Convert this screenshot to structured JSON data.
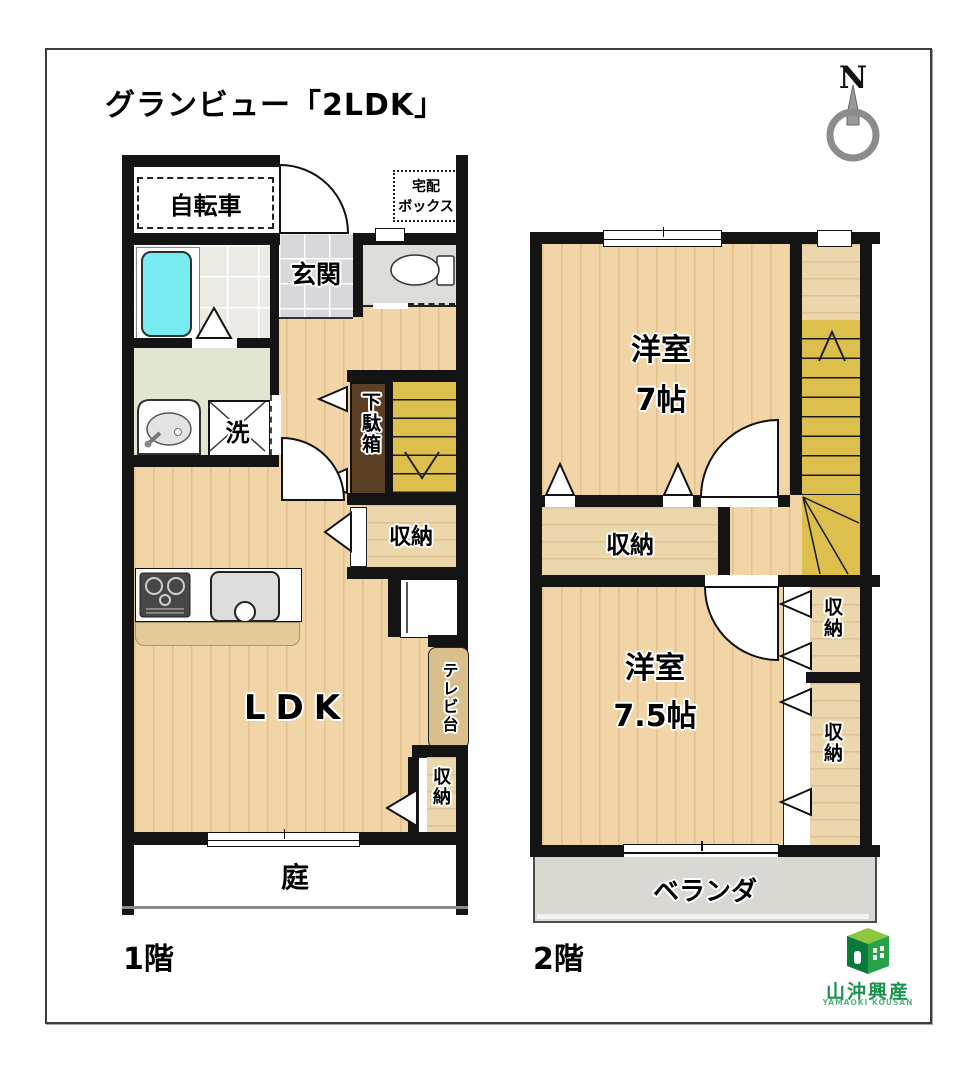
{
  "title": "グランビュー「2LDK」",
  "compass": {
    "n": "N"
  },
  "f1": {
    "caption": "1階",
    "bicycle": "自転車",
    "delivery1": "宅配",
    "delivery2": "ボックス",
    "genkan": "玄関",
    "wash": "洗",
    "shoe_cabinet": "下駄箱",
    "storage_stairs": "収納",
    "ldk": "LDK",
    "tv_stand": "テレビ台",
    "storage_ldk": "収納",
    "garden": "庭"
  },
  "f2": {
    "caption": "2階",
    "room7_line1": "洋室",
    "room7_line2": "7帖",
    "storage_hall": "収納",
    "room75_line1": "洋室",
    "room75_line2": "7.5帖",
    "storage_upper": "収納",
    "storage_lower": "収納",
    "veranda": "ベランダ"
  },
  "logo": {
    "company": "山沖興産",
    "romaji": "YAMAOKI KOUSAN"
  },
  "colors": {
    "wood": "#f2d5a7",
    "stairs": "#ddbf4e",
    "tub": "#76ebf0",
    "shoe_cabinet": "#5b3f24",
    "logo_green": "#17934b"
  }
}
